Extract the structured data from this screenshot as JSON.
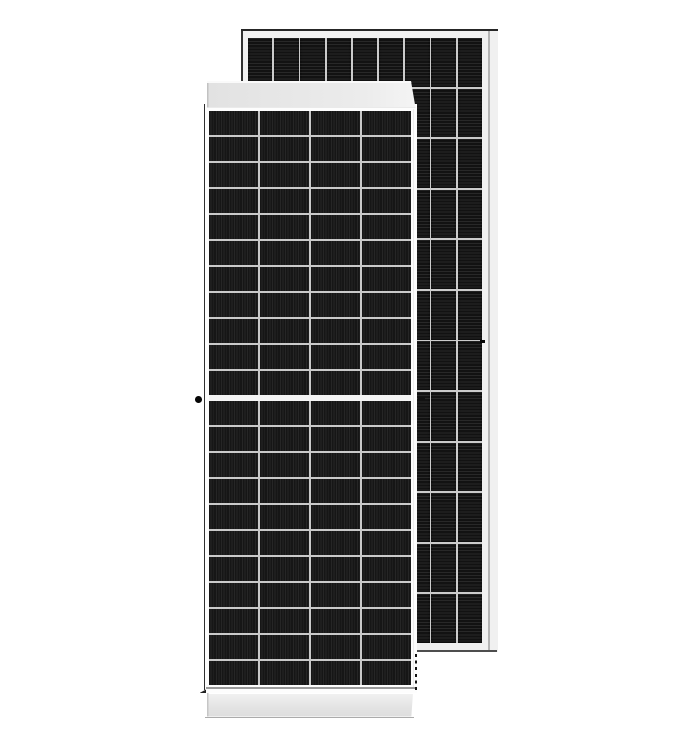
{
  "scene": {
    "type": "product-photo",
    "subject": "Two framed monocrystalline half-cut solar panel modules, front view module in foreground with a second module standing behind to the right",
    "background_color": "#ffffff"
  },
  "colors": {
    "background": "#ffffff",
    "frame_light": "#f1f1f1",
    "outline_dark": "#262626",
    "glass_white": "#fdfdfd",
    "front_cell_dark": "#161616",
    "front_cell_light": "#262626",
    "front_grid_line": "#c9c9c9",
    "center_gap": "#f4f4f4",
    "back_cell_dark": "#121212",
    "back_grid_line": "#cbcbcb"
  },
  "front_module": {
    "view": "front, portrait orientation",
    "cell_grid": {
      "columns": 4,
      "rows_top_half": 11,
      "rows_bottom_half": 11,
      "center_gap": true
    },
    "cell_texture": "fine vertical busbar stripes",
    "frame": {
      "top_bar": "light gray end-cap, slanted right edge",
      "bottom_bar": "light gray end-cap with drop shadow",
      "left_edge": "thin dark frame line",
      "right_edge_lower": "dashed dark edge below rear module"
    },
    "hardware_marks": [
      "grounding hole dot on left frame at mid-height",
      "drain slot dash right of frame at mid-height"
    ]
  },
  "rear_module": {
    "view": "standing behind, offset right",
    "cell_grid": {
      "columns": 9,
      "rows": 12
    },
    "cell_texture": "fine horizontal busbar stripes",
    "frame": {
      "outline": "dark line along top and left",
      "right_side_face": "pale frame side profile",
      "bottom": "dark shadow line"
    },
    "hardware_marks": [
      "grounding dash on right frame at mid-height"
    ]
  }
}
